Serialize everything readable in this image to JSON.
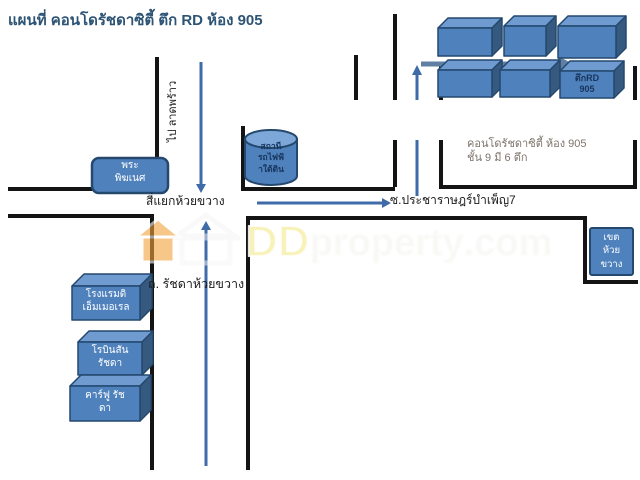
{
  "title": "แผนที่ คอนโดรัชดาซิตี้ ตึก RD ห้อง 905",
  "labels": {
    "intersection": "สี่แยกห้วยขวาง",
    "soi": "ซ.ประชาราษฎร์บำเพ็ญ7",
    "south_road": "ถ. รัชดาห้วยขวาง",
    "north_direction": "ไป ลาดพร้าว"
  },
  "places": {
    "shrine": {
      "line1": "พระ",
      "line2": "พิฆเนศ"
    },
    "mrt_station": {
      "line1": "สถานี",
      "line2": "รถไฟฟ้",
      "line3": "าใต้ดิน"
    },
    "emerald_hotel": {
      "line1": "โรงแรมดิ",
      "line2": "เอ็มเมอเรล"
    },
    "robinson": {
      "line1": "โรบินสัน",
      "line2": "รัชดา"
    },
    "carrefour": {
      "line1": "คาร์ฟู รัช",
      "line2": "ดา"
    },
    "district_office": {
      "line1": "เขต",
      "line2": "ห้วย",
      "line3": "ขวาง"
    },
    "rd_building": {
      "line1": "ตึกRD",
      "line2": "905"
    }
  },
  "annotation": {
    "line1": "คอนโดรัชดาซิตี้ ห้อง 905",
    "line2": "ชั้น 9 มี 6 ตึก"
  },
  "watermark": {
    "dd": "DD",
    "property": "property",
    "com": ".com"
  },
  "colors": {
    "box_fill": "#4f81bd",
    "box_top": "#6f9bd1",
    "box_side": "#36597f",
    "box_border": "#24486e",
    "road": "#141414",
    "route_arrow": "#3f6ba8",
    "big_arrow": "#5f7fa3",
    "title_text": "#2d5474",
    "watermark_orange": "#f2a33c"
  }
}
